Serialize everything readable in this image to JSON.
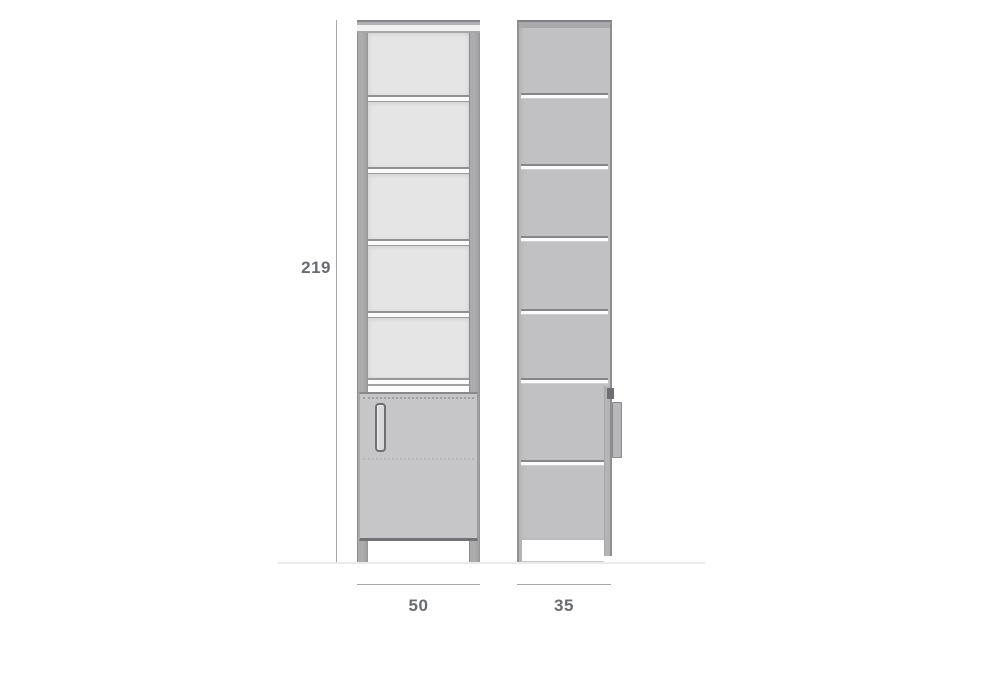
{
  "diagram": {
    "dimension_labels": {
      "height": "219",
      "width": "50",
      "depth": "35"
    },
    "front_view": {
      "shelf_compartments": 5,
      "has_bottom_door": true,
      "has_door_handle": true
    },
    "side_view": {
      "sections": 7,
      "handle_protrudes_right": true
    },
    "colors": {
      "front_interior": "#e5e5e6",
      "front_frame": "#acacaf",
      "door": "#c6c6c9",
      "side_body": "#c1c1c3",
      "dimension_line": "#a7a7a8",
      "label_text": "#686c71",
      "background": "#ffffff"
    }
  }
}
